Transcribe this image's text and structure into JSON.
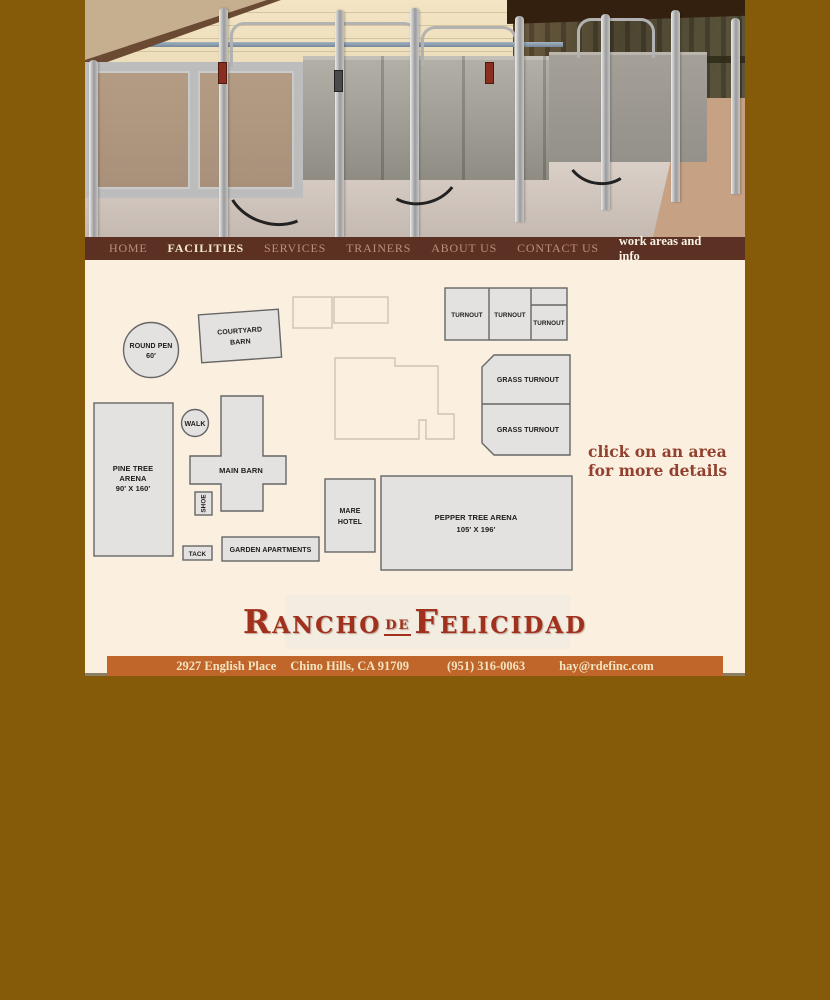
{
  "nav": {
    "items": [
      {
        "label": "HOME",
        "active": false
      },
      {
        "label": "FACILITIES",
        "active": true
      },
      {
        "label": "SERVICES",
        "active": false
      },
      {
        "label": "TRAINERS",
        "active": false
      },
      {
        "label": "ABOUT US",
        "active": false
      },
      {
        "label": "CONTACT US",
        "active": false
      }
    ],
    "right_label": "work areas and info"
  },
  "map": {
    "hint_line1": "click on an area",
    "hint_line2": "for more details",
    "round_pen": {
      "line1": "ROUND PEN",
      "line2": "60′"
    },
    "courtyard_barn": {
      "line1": "COURTYARD",
      "line2": "BARN"
    },
    "turnout1": "TURNOUT",
    "turnout2": "TURNOUT",
    "turnout3": "TURNOUT",
    "grass_turnout1": "GRASS TURNOUT",
    "grass_turnout2": "GRASS TURNOUT",
    "pine_tree_arena": {
      "line1": "PINE TREE",
      "line2": "ARENA",
      "line3": "90′ X 160′"
    },
    "walk": "WALK",
    "main_barn": "MAIN BARN",
    "shoe": "SHOE",
    "tack": "TACK",
    "garden_apartments": "GARDEN APARTMENTS",
    "mare_hotel": {
      "line1": "MARE",
      "line2": "HOTEL"
    },
    "pepper_tree_arena": {
      "line1": "PEPPER TREE ARENA",
      "line2": "105′ X 196′"
    }
  },
  "logo": {
    "word1": "Rancho",
    "word2": "de",
    "word3": "Felicidad"
  },
  "footer": {
    "address": "2927 English Place",
    "city": "Chino Hills, CA 91709",
    "phone": "(951) 316-0063",
    "email": "hay@rdefinc.com"
  },
  "colors": {
    "background": "#855a08",
    "page_bg": "#fbf0e0",
    "nav_bg": "#5c3022",
    "nav_active_text": "#f3e9cd",
    "nav_inactive_text": "#bb8f7d",
    "footer_bg": "#c0662a",
    "footer_text": "#f3e3c0",
    "logo_red": "#a1301c",
    "hint_red": "#93412f",
    "building_fill": "#e3e2e1",
    "building_stroke": "#666666"
  }
}
